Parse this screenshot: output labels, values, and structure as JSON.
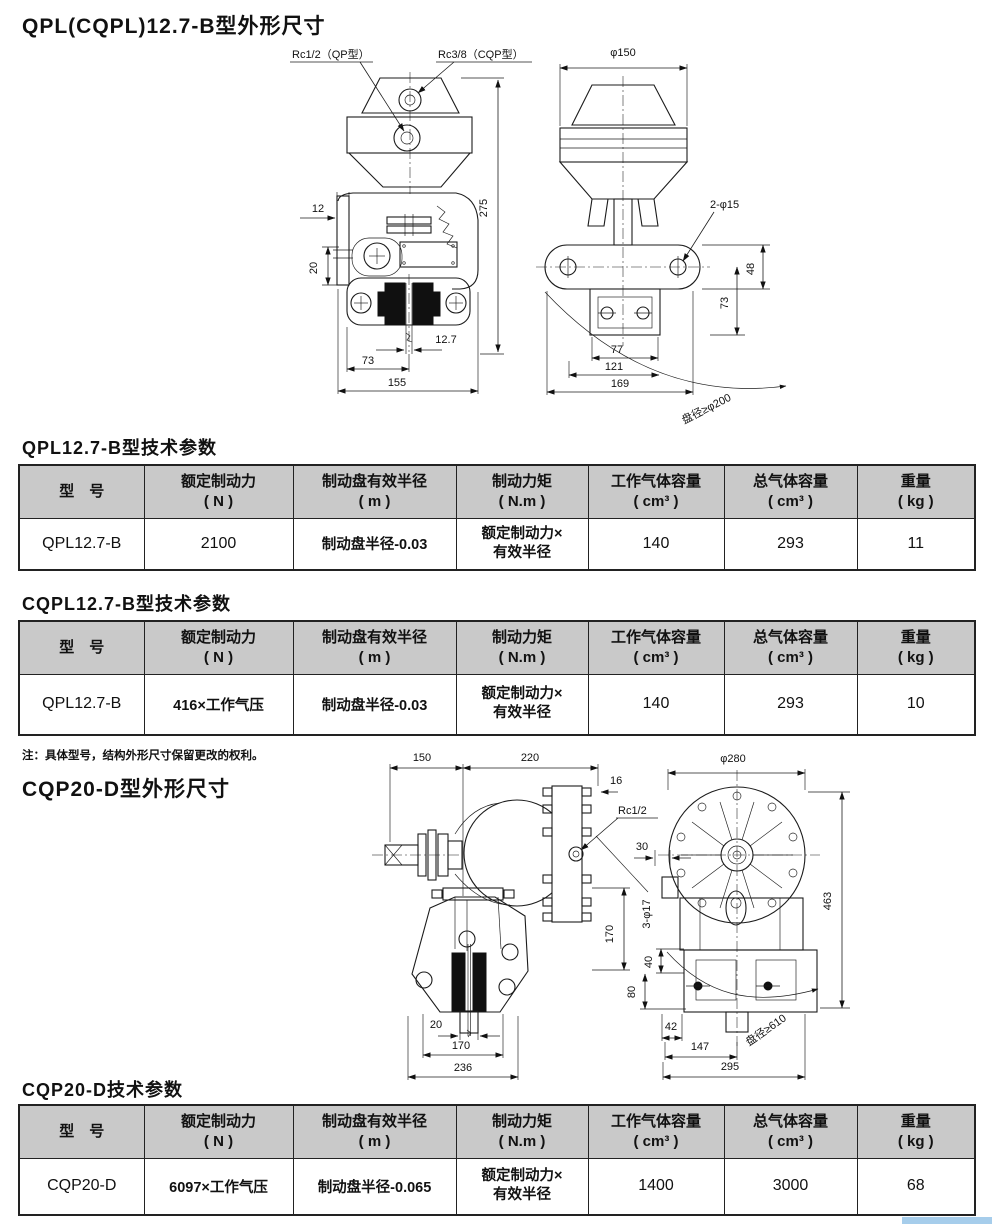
{
  "titles": {
    "section1": "QPL(CQPL)12.7-B型外形尺寸",
    "section2": "CQP20-D型外形尺寸",
    "note": "注：具体型号，结构外形尺寸保留更改的权利。"
  },
  "colors": {
    "header_bg": "#c9c9c9",
    "border": "#222222",
    "accent_bar": "#a6cdeb",
    "pad_fill": "#101010"
  },
  "figures": {
    "qpl": {
      "qp_label": "Rc1/2（QP型）",
      "cqp_label": "Rc3/8（CQP型）",
      "d12": "12",
      "d20": "20",
      "d275": "275",
      "d12_7": "12.7",
      "d73_front": "73",
      "d155": "155",
      "d150": "φ150",
      "d2_15": "2-φ15",
      "d48": "48",
      "d73_side": "73",
      "d77": "77",
      "d121": "121",
      "d169": "169",
      "disc": "盘径≥φ200"
    },
    "cqp": {
      "d150": "150",
      "d220": "220",
      "d16": "16",
      "rc": "Rc1/2",
      "d20": "20",
      "d170_bottom": "170",
      "d236": "236",
      "d170_side": "170",
      "d3_17": "3-φ17",
      "d30": "30",
      "d40": "40",
      "d80": "80",
      "d280": "φ280",
      "d463": "463",
      "d42": "42",
      "d147": "147",
      "d295": "295",
      "disc": "盘径≥610"
    }
  },
  "tables": {
    "headers": [
      {
        "l1": "型　号",
        "l2": ""
      },
      {
        "l1": "额定制动力",
        "l2": "( N )"
      },
      {
        "l1": "制动盘有效半径",
        "l2": "( m )"
      },
      {
        "l1": "制动力矩",
        "l2": "( N.m )"
      },
      {
        "l1": "工作气体容量",
        "l2": "( cm³ )"
      },
      {
        "l1": "总气体容量",
        "l2": "( cm³ )"
      },
      {
        "l1": "重量",
        "l2": "( kg )"
      }
    ],
    "qpl127b": {
      "title": "QPL12.7-B型技术参数",
      "row": {
        "model": "QPL12.7-B",
        "force": "2100",
        "radius": "制动盘半径-0.03",
        "torque1": "额定制动力×",
        "torque2": "有效半径",
        "work": "140",
        "total": "293",
        "weight": "11"
      }
    },
    "cqpl127b": {
      "title": "CQPL12.7-B型技术参数",
      "row": {
        "model": "QPL12.7-B",
        "force": "416×工作气压",
        "radius": "制动盘半径-0.03",
        "torque1": "额定制动力×",
        "torque2": "有效半径",
        "work": "140",
        "total": "293",
        "weight": "10"
      }
    },
    "cqp20d": {
      "title": "CQP20-D技术参数",
      "row": {
        "model": "CQP20-D",
        "force": "6097×工作气压",
        "radius": "制动盘半径-0.065",
        "torque1": "额定制动力×",
        "torque2": "有效半径",
        "work": "1400",
        "total": "3000",
        "weight": "68"
      }
    }
  }
}
